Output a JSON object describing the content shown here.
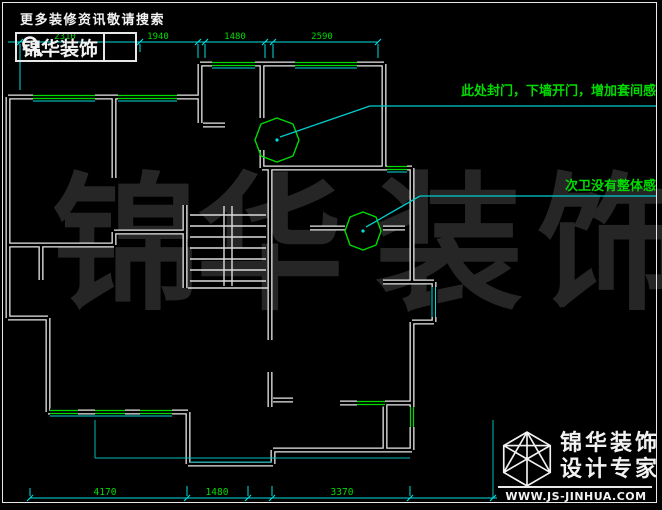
{
  "colors": {
    "background": "#000000",
    "wall_white": "#e8e8e8",
    "dim_cyan": "#00dede",
    "note_green": "#00dc00",
    "watermark_gray": "#262626",
    "text_white": "#f2f2f2"
  },
  "header": {
    "slogan": "更多装修资讯敬请搜索",
    "brand": "锦华装饰"
  },
  "dimensions": {
    "top": [
      "2310",
      "1940",
      "1480",
      "2590"
    ],
    "bottom": [
      "4170",
      "1480",
      "3370"
    ]
  },
  "annotations": [
    {
      "text": "此处封门，下墙开门，增加套间感"
    },
    {
      "text": "次卫没有整体感"
    }
  ],
  "watermark": {
    "chars": [
      "锦",
      "华",
      "装",
      "饰"
    ]
  },
  "footer": {
    "brand_line1": "锦华装饰",
    "brand_line2": "设计专家",
    "website": "WWW.JS-JINHUA.COM"
  }
}
